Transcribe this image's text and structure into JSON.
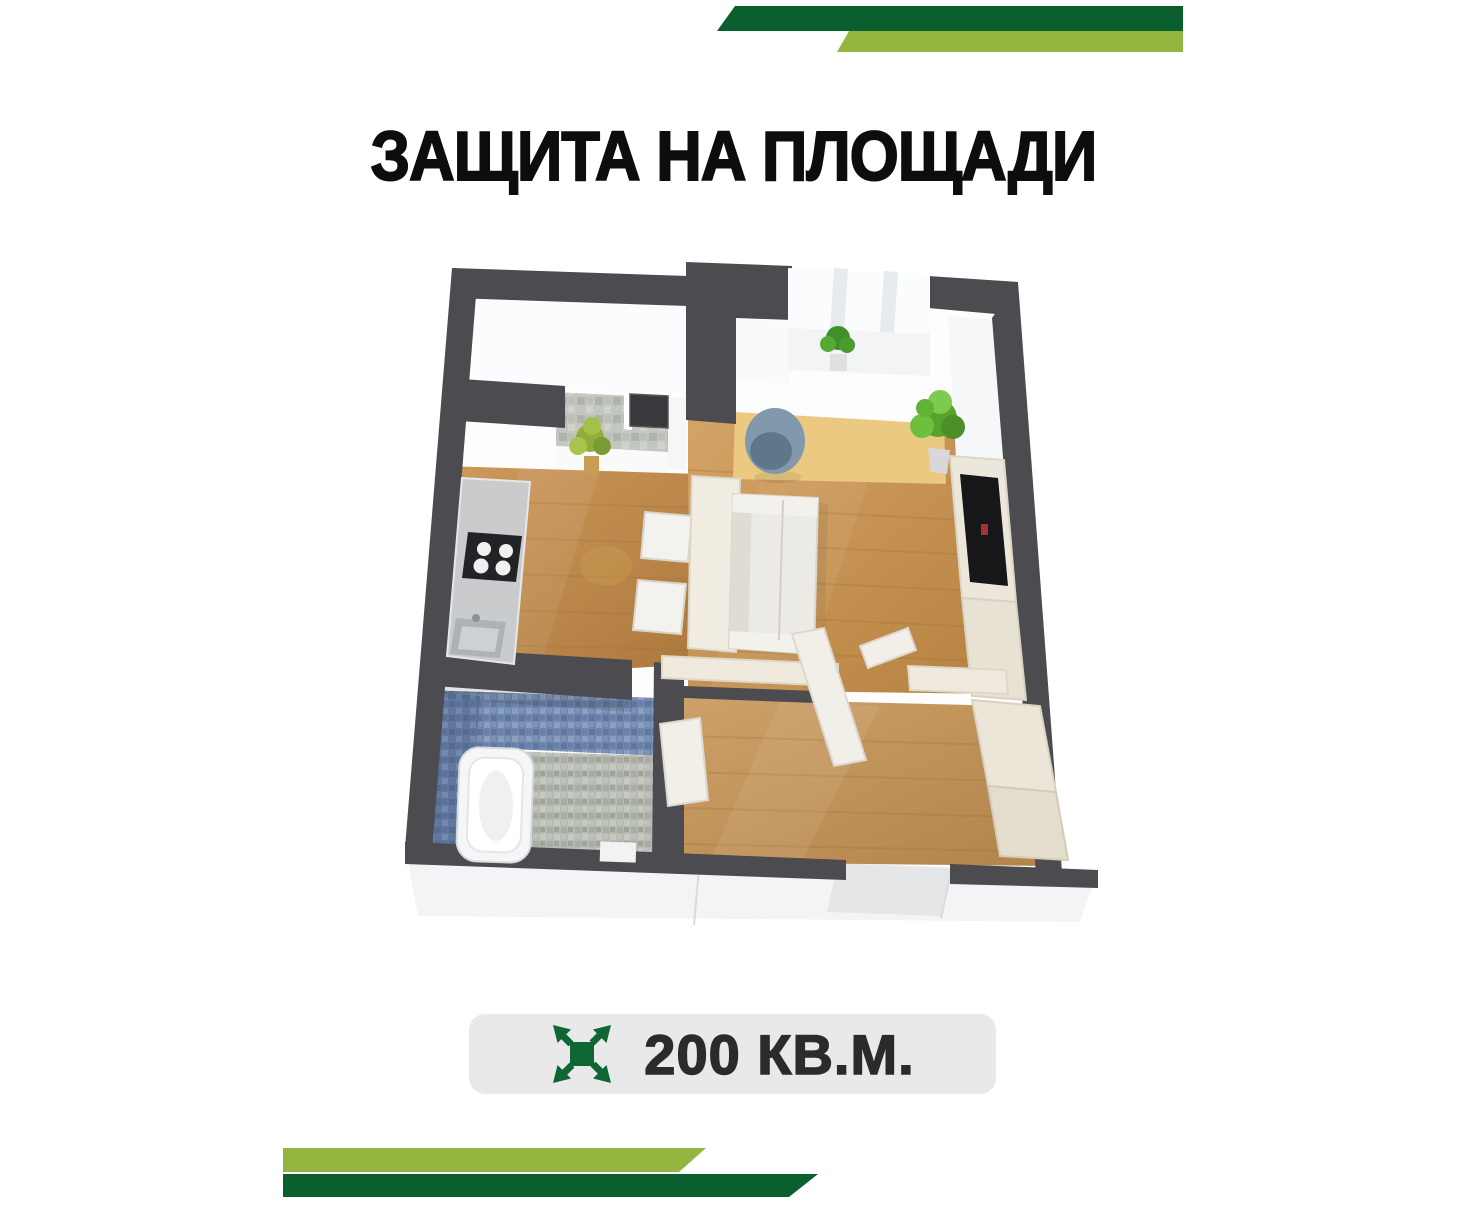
{
  "poster": {
    "title": "ЗАЩИТА НА ПЛОЩАДИ",
    "badge": {
      "area_label": "200 КВ.М.",
      "icon": "expand-arrows-icon"
    },
    "colors": {
      "dark_green": "#0B5E2D",
      "light_green": "#94B53F",
      "title_text": "#0D0D0D",
      "badge_background": "#E9E9E9",
      "badge_text": "#2B2B2B",
      "badge_icon_green": "#0E6633"
    },
    "floor_plan": {
      "style": "3d-top-down-render",
      "colors": {
        "walls": "#4B4B50",
        "wood_floor": "#C89355",
        "accent_rug": "#ECC981",
        "bathroom_wall_tile": "#7289AC",
        "bathroom_floor_tile": "#B7BAB2",
        "furniture_cream": "#EFEADF",
        "kitchen_counter": "#C9CBCC"
      }
    }
  }
}
